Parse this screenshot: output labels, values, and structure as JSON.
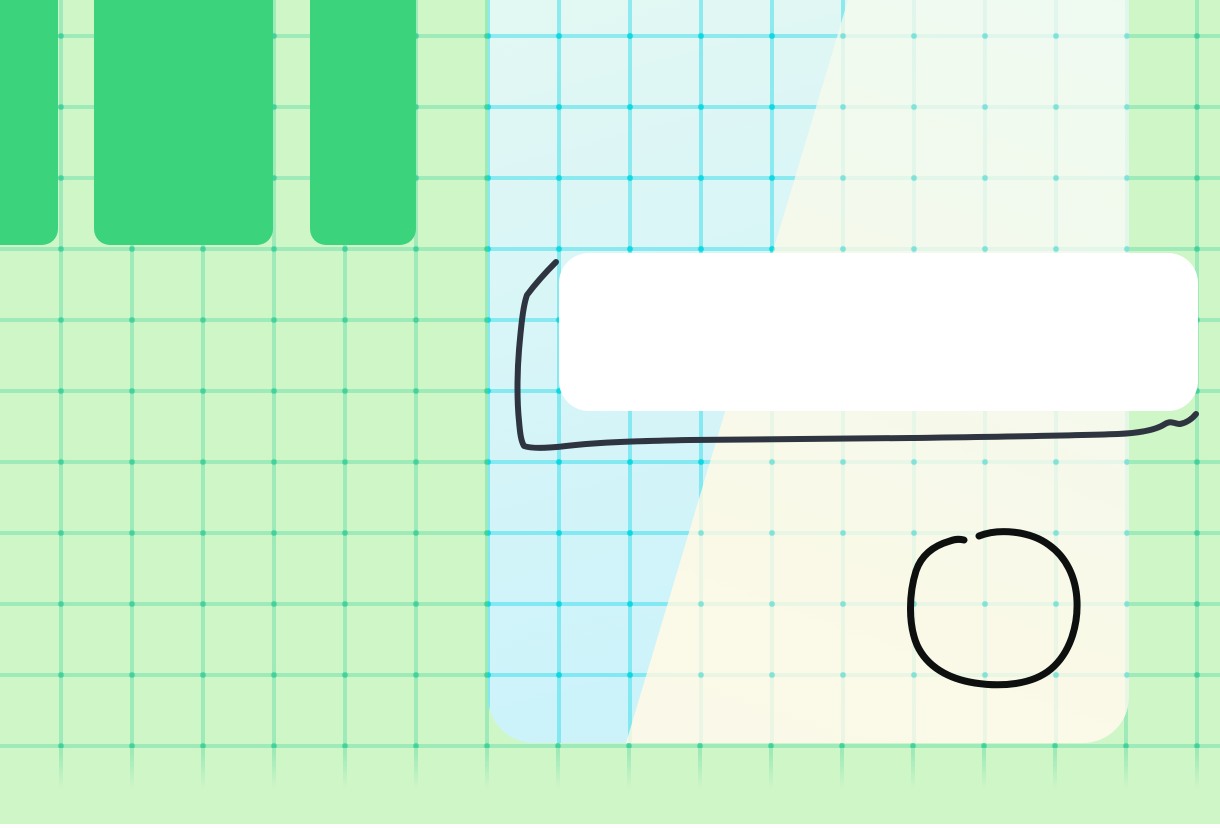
{
  "app": {
    "type": "whiteboard-canvas",
    "visible_text": []
  },
  "palette": {
    "background_green": "#CFF6C7",
    "grid_line_green": "rgba(47,205,152,0.30)",
    "grid_dot_green": "rgba(21,199,141,0.55)",
    "pillar_green": "#3CD37D",
    "panel_cyan_top": "#E4F8F2",
    "panel_cyan_bottom": "#C8F2FA",
    "panel_cream_top": "#EEFAF1",
    "panel_cream_bottom": "#FAF8E8",
    "panel_grid_cyan": "rgba(26,216,230,0.42)",
    "panel_grid_dot_cyan": "rgba(0,214,224,0.85)",
    "card_white": "#FFFFFF",
    "bottom_strip_white": "#FDFEFB"
  },
  "grid": {
    "cell_px": 71
  },
  "ink": {
    "rect_color": "#2F3540",
    "rect_width": "6",
    "rect_path": "M556 262 C549 269 536 283 527 295 C523 306 521 327 519 350 C517 374 517 402 519 421 C520 433 521 441 524 446 C532 449 549 448 566 446 C600 442 642 441 690 440 C760 439 840 439 910 438 C980 437 1060 436 1118 434 C1140 433 1156 430 1165 424 C1171 420 1175 424 1180 424 C1186 423 1192 419 1196 414",
    "circle_color": "#0D100E",
    "circle_width": "7",
    "circle_path": "M979 536 C999 528 1030 531 1049 545 C1066 557 1076 577 1077 601 C1078 626 1070 653 1051 669 C1032 685 1001 687 975 683 C949 679 927 667 917 645 C908 624 909 593 916 571 C922 553 936 545 950 541 C955 539 960 539 964 540"
  }
}
